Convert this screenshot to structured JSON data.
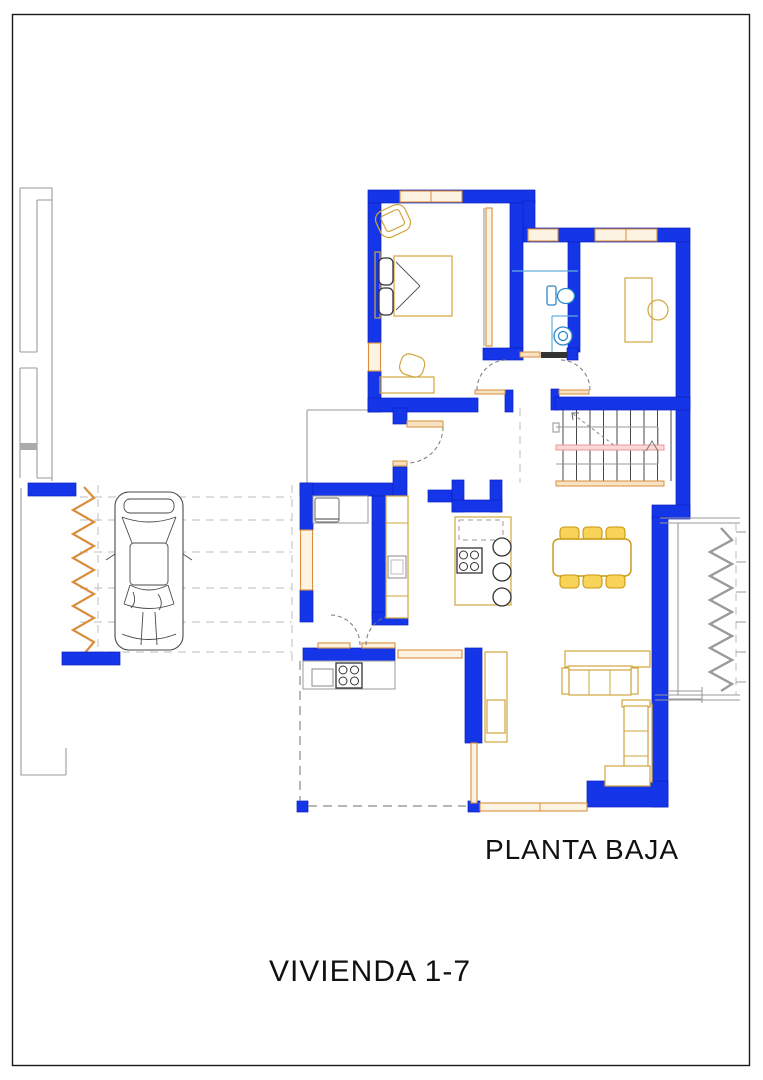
{
  "labels": {
    "plan_title": "PLANTA BAJA",
    "dwelling_title": "VIVIENDA 1-7"
  },
  "drawing": {
    "type": "architectural floor plan, ground floor of detached dwelling",
    "floor_shown": "PLANTA BAJA",
    "unit_shown": "VIVIENDA 1-7",
    "rooms": [
      "bedroom",
      "bathroom",
      "study",
      "hallway",
      "staircase",
      "entry-vestibule",
      "kitchen",
      "living-dining-room",
      "porch",
      "terrace",
      "driveway-carport"
    ],
    "elements": [
      "double-bed",
      "pillows",
      "armchair",
      "bedroom-desk",
      "desk-chair",
      "built-in-wardrobe",
      "toilet",
      "washbasin",
      "shower-screen",
      "study-desk",
      "study-chair",
      "refrigerator",
      "kitchen-counter",
      "oven",
      "island-cooktop",
      "bar-stools",
      "outdoor-cooktop",
      "outdoor-sink",
      "dining-table",
      "six-dining-chairs",
      "three-seat-sofa",
      "chaise-sofa",
      "console-table",
      "side-table",
      "tall-cabinet",
      "car",
      "stairs-with-handrail",
      "entry-door",
      "interior-door-arcs",
      "window-sills",
      "fence-zigzag"
    ]
  },
  "colors": {
    "frame": "#1a1a1a",
    "wall": "#1536E8",
    "wall_edge": "#0A1EC0",
    "window": "#D98E3B",
    "window_fill": "#FDF3E2",
    "sill_fill": "#F7E3C3",
    "furniture": "#D2A63C",
    "furniture_dark": "#C8960F",
    "chair_fill": "#F7D458",
    "counter_gray": "#999999",
    "dark": "#333333",
    "neighbor": "#9A9A9A",
    "paving": "#BDBDBD",
    "fixture": "#2B87C8",
    "shower": "#63AEDC",
    "car_line": "#4A4A4A",
    "stair_pink": "#E89898",
    "stair_pink_fill": "#FBD9D9",
    "text": "#111111"
  }
}
